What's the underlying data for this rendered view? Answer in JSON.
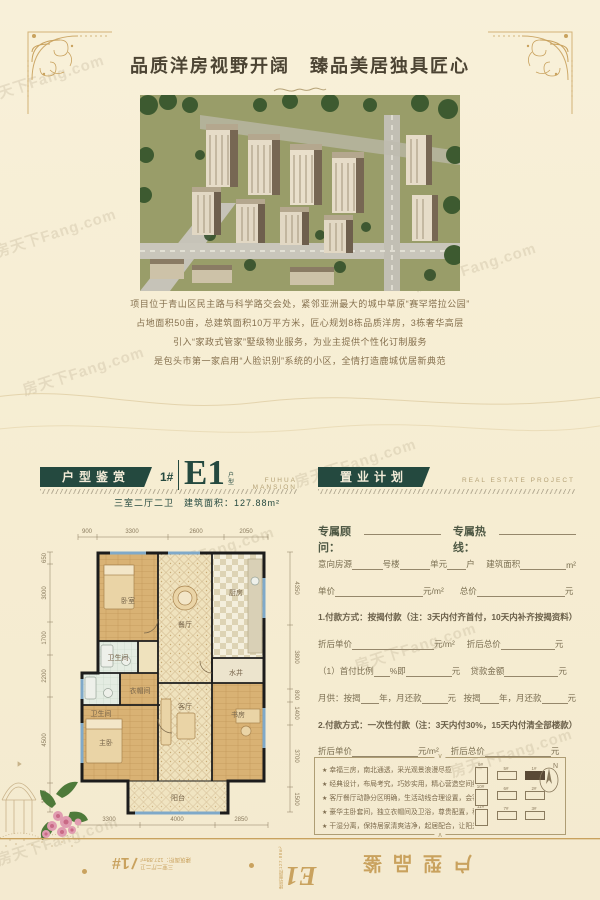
{
  "watermark": {
    "text": "房天下Fang.com"
  },
  "header": {
    "title": "品质洋房视野开阔　臻品美居独具匠心"
  },
  "intro": {
    "lines": [
      "项目位于青山区民主路与科学路交会处，紧邻亚洲最大的城中草原“赛罕塔拉公园”",
      "占地面积50亩，总建筑面积10万平方米，匠心规划8栋品质洋房，3栋奢华高层",
      "引入“家政式管家”墅级物业服务，为业主提供个性化订制服务",
      "是包头市第一家启用“人脸识别”系统的小区，全情打造鹿城优居新典范"
    ]
  },
  "floorplan_section": {
    "badge": "户型鉴赏",
    "building_no": "1#",
    "unit_name": "E1",
    "unit_suffix": "户型",
    "en_caption": "FUHUA MANSION",
    "spec": "三室二厅二卫　建筑面积：127.88m²"
  },
  "plan_section": {
    "badge": "置业计划",
    "en_caption": "REAL ESTATE PROJECT"
  },
  "floorplan": {
    "dims_top": [
      "900",
      "3300",
      "2600",
      "2050"
    ],
    "dims_left": [
      "650",
      "3000",
      "1700",
      "2200",
      "4500",
      "1500"
    ],
    "dims_right": [
      "4350",
      "3800",
      "800",
      "1400",
      "3700",
      "1500"
    ],
    "dims_bottom": [
      "3300",
      "4000",
      "2850"
    ],
    "rooms": {
      "bedroom": "卧室",
      "dining": "餐厅",
      "kitchen": "厨房",
      "bath1": "卫生间",
      "bath2": "卫生间",
      "cloak": "衣帽间",
      "master": "主卧",
      "living": "客厅",
      "study": "书房",
      "well": "水井",
      "balcony": "阳台"
    }
  },
  "form": {
    "advisor_label": "专属顾问：",
    "hotline_label": "专属热线：",
    "rows": [
      {
        "cells": [
          {
            "t": "意向房源"
          },
          {
            "u": 32
          },
          {
            "t": "号楼"
          },
          {
            "u": 32
          },
          {
            "t": "单元"
          },
          {
            "u": 20
          },
          {
            "t": "户"
          },
          {
            "s": 12
          },
          {
            "t": "建筑面积"
          },
          {
            "u": 48
          },
          {
            "t": "m²"
          }
        ]
      },
      {
        "cells": [
          {
            "t": "单价"
          },
          {
            "u": 88
          },
          {
            "t": "元/m²"
          },
          {
            "s": 16
          },
          {
            "t": "总价"
          },
          {
            "u": 88
          },
          {
            "t": "元"
          }
        ]
      },
      {
        "note": true,
        "cells": [
          {
            "t": "1.付款方式：按揭付款（注：3天内付齐首付，10天内补齐按揭资料）"
          }
        ]
      },
      {
        "cells": [
          {
            "t": "折后单价"
          },
          {
            "u": 82
          },
          {
            "t": "元/m²"
          },
          {
            "s": 12
          },
          {
            "t": "折后总价"
          },
          {
            "u": 54
          },
          {
            "t": "元"
          }
        ]
      },
      {
        "cells": [
          {
            "t": "（1）首付比例"
          },
          {
            "u": 16
          },
          {
            "t": "%即"
          },
          {
            "u": 46
          },
          {
            "t": "元"
          },
          {
            "s": 10
          },
          {
            "t": "贷款金额"
          },
          {
            "u": 54
          },
          {
            "t": "元"
          }
        ]
      },
      {
        "cells": [
          {
            "t": "月供：按揭"
          },
          {
            "u": 20
          },
          {
            "t": "年，月还款"
          },
          {
            "u": 28
          },
          {
            "t": "元"
          },
          {
            "s": 8
          },
          {
            "t": "按揭"
          },
          {
            "u": 20
          },
          {
            "t": "年，月还款"
          },
          {
            "u": 28
          },
          {
            "t": "元"
          }
        ]
      },
      {
        "note": true,
        "cells": [
          {
            "t": "2.付款方式：一次性付款（注：3天内付30%，15天内付清全部楼款）"
          }
        ]
      },
      {
        "cells": [
          {
            "t": "折后单价"
          },
          {
            "u": 66
          },
          {
            "t": "元/m²"
          },
          {
            "s": 12
          },
          {
            "t": "折后总价"
          },
          {
            "u": 66
          },
          {
            "t": "元"
          }
        ]
      }
    ]
  },
  "features": {
    "bullet": "★",
    "items": [
      "幸福三房，南北通透，采光观景浪漫尽揽",
      "经典设计，布局考究，巧妙实用，精心营造空间维度",
      "客厅餐厅动静分区明确，生活动线合理设置，会客、休息互不干扰",
      "豪华主卧套间，独立衣帽间及卫浴，尊贵配置，私享品质生活",
      "干湿分离，保持居家清爽洁净，起居配合，让阳光舒适蔓延"
    ]
  },
  "siteplan": {
    "compass": "N",
    "buildings": [
      "9#",
      "10#",
      "11#",
      "5#",
      "6#",
      "7#",
      "1#",
      "2#",
      "3#"
    ]
  },
  "footer": {
    "building_no": "1#",
    "spec": "三室二厅二卫",
    "area": "建筑面积：127.88m²",
    "unit": "E1",
    "unit_area_label": "建筑面积",
    "unit_area": "127.88m²",
    "title": "户型品鉴"
  },
  "decor": {
    "notch_top": "∨",
    "notch_bottom": "∧"
  },
  "colors": {
    "gold": "#c9a25e",
    "teal": "#24493f",
    "cream": "#f6edd2"
  }
}
